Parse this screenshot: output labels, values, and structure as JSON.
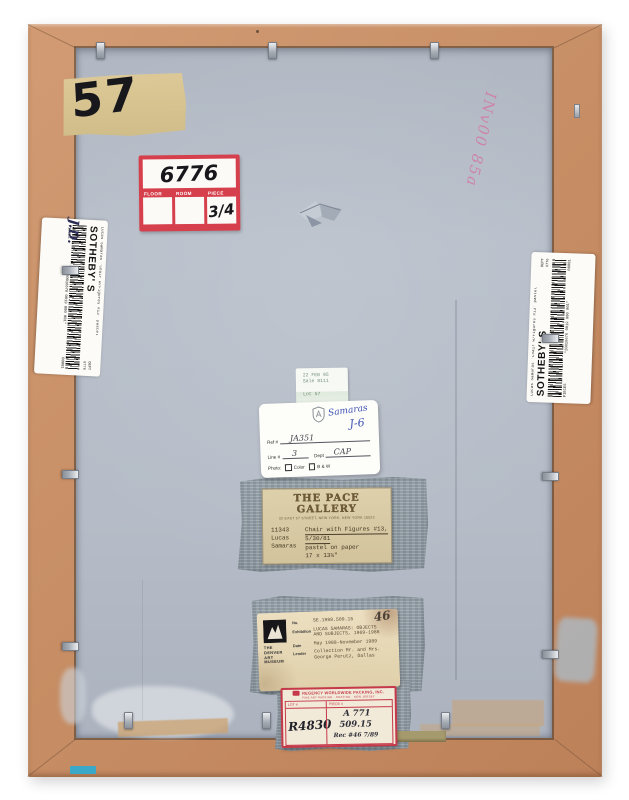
{
  "photo": {
    "lot_tape_number": "57",
    "red_label": {
      "number": "6776",
      "col_floor": "FLOOR",
      "col_room": "ROOM",
      "col_piece": "PIECE",
      "piece_value": "3/4"
    },
    "inventory_note": "INv00 85a",
    "sothebys": {
      "brand": "SOTHEBY' S",
      "item": "Lucas  Samaras   'Chair  w/Figures  #13'   pastel",
      "barcode_number": "*20016676 0019 000 001*",
      "dept_label": "DEPT",
      "dept_value": "6776",
      "pieces_label": "PIECES",
      "pieces_value": "00001",
      "initials": "J.D."
    },
    "sale_sticker": {
      "date": "22 FEB 95",
      "sale": "Sale 8111",
      "lot": "Lot 57"
    },
    "registration": {
      "artist": "Samaras",
      "code": "J-6",
      "ref_label": "Ref #",
      "ref_value": "JA351",
      "line_label": "Line #",
      "line_value": "3",
      "dept_label": "Dept",
      "dept_value": "CAP",
      "photo_label": "Photo:",
      "opt_color": "Color",
      "opt_bw": "B & W"
    },
    "pace": {
      "gallery": "THE PACE GALLERY",
      "address": "32 EAST 57 STREET, NEW YORK, NEW YORK 10022",
      "stock_no": "11343",
      "artist_line1": "Lucas",
      "artist_line2": "Samaras",
      "title": "Chair with Figures #13,",
      "date": "5/30/81",
      "medium": "pastel on paper",
      "size": "17 x 13¼\""
    },
    "denver": {
      "museum_line1": "THE",
      "museum_line2": "DENVER",
      "museum_line3": "ART",
      "museum_line4": "MUSEUM",
      "no_label": "No.",
      "no_value": "SE.1988.509.15",
      "hand_no": "46",
      "exh_label": "Exhibition",
      "exh_value1": "LUCAS SAMARAS:  OBJECTS",
      "exh_value2": "AND SUBJECTS, 1969-1986",
      "date_label": "Date",
      "date_value": "May 1988-November 1989",
      "lender_label": "Lender",
      "lender_value1": "Collection Mr. and Mrs.",
      "lender_value2": "George Perutz, Dallas"
    },
    "regency": {
      "company": "REGENCY WORLDWIDE PACKING, INC.",
      "address": "FINE ART PACKING · CRATING · NEW JERSEY",
      "lot_label": "LOT #",
      "piece_label": "PIECE #",
      "lot_value": "R4830",
      "piece_line1": "A 771",
      "piece_line2": "509.15",
      "piece_line3": "Rec #46  7/89"
    }
  }
}
